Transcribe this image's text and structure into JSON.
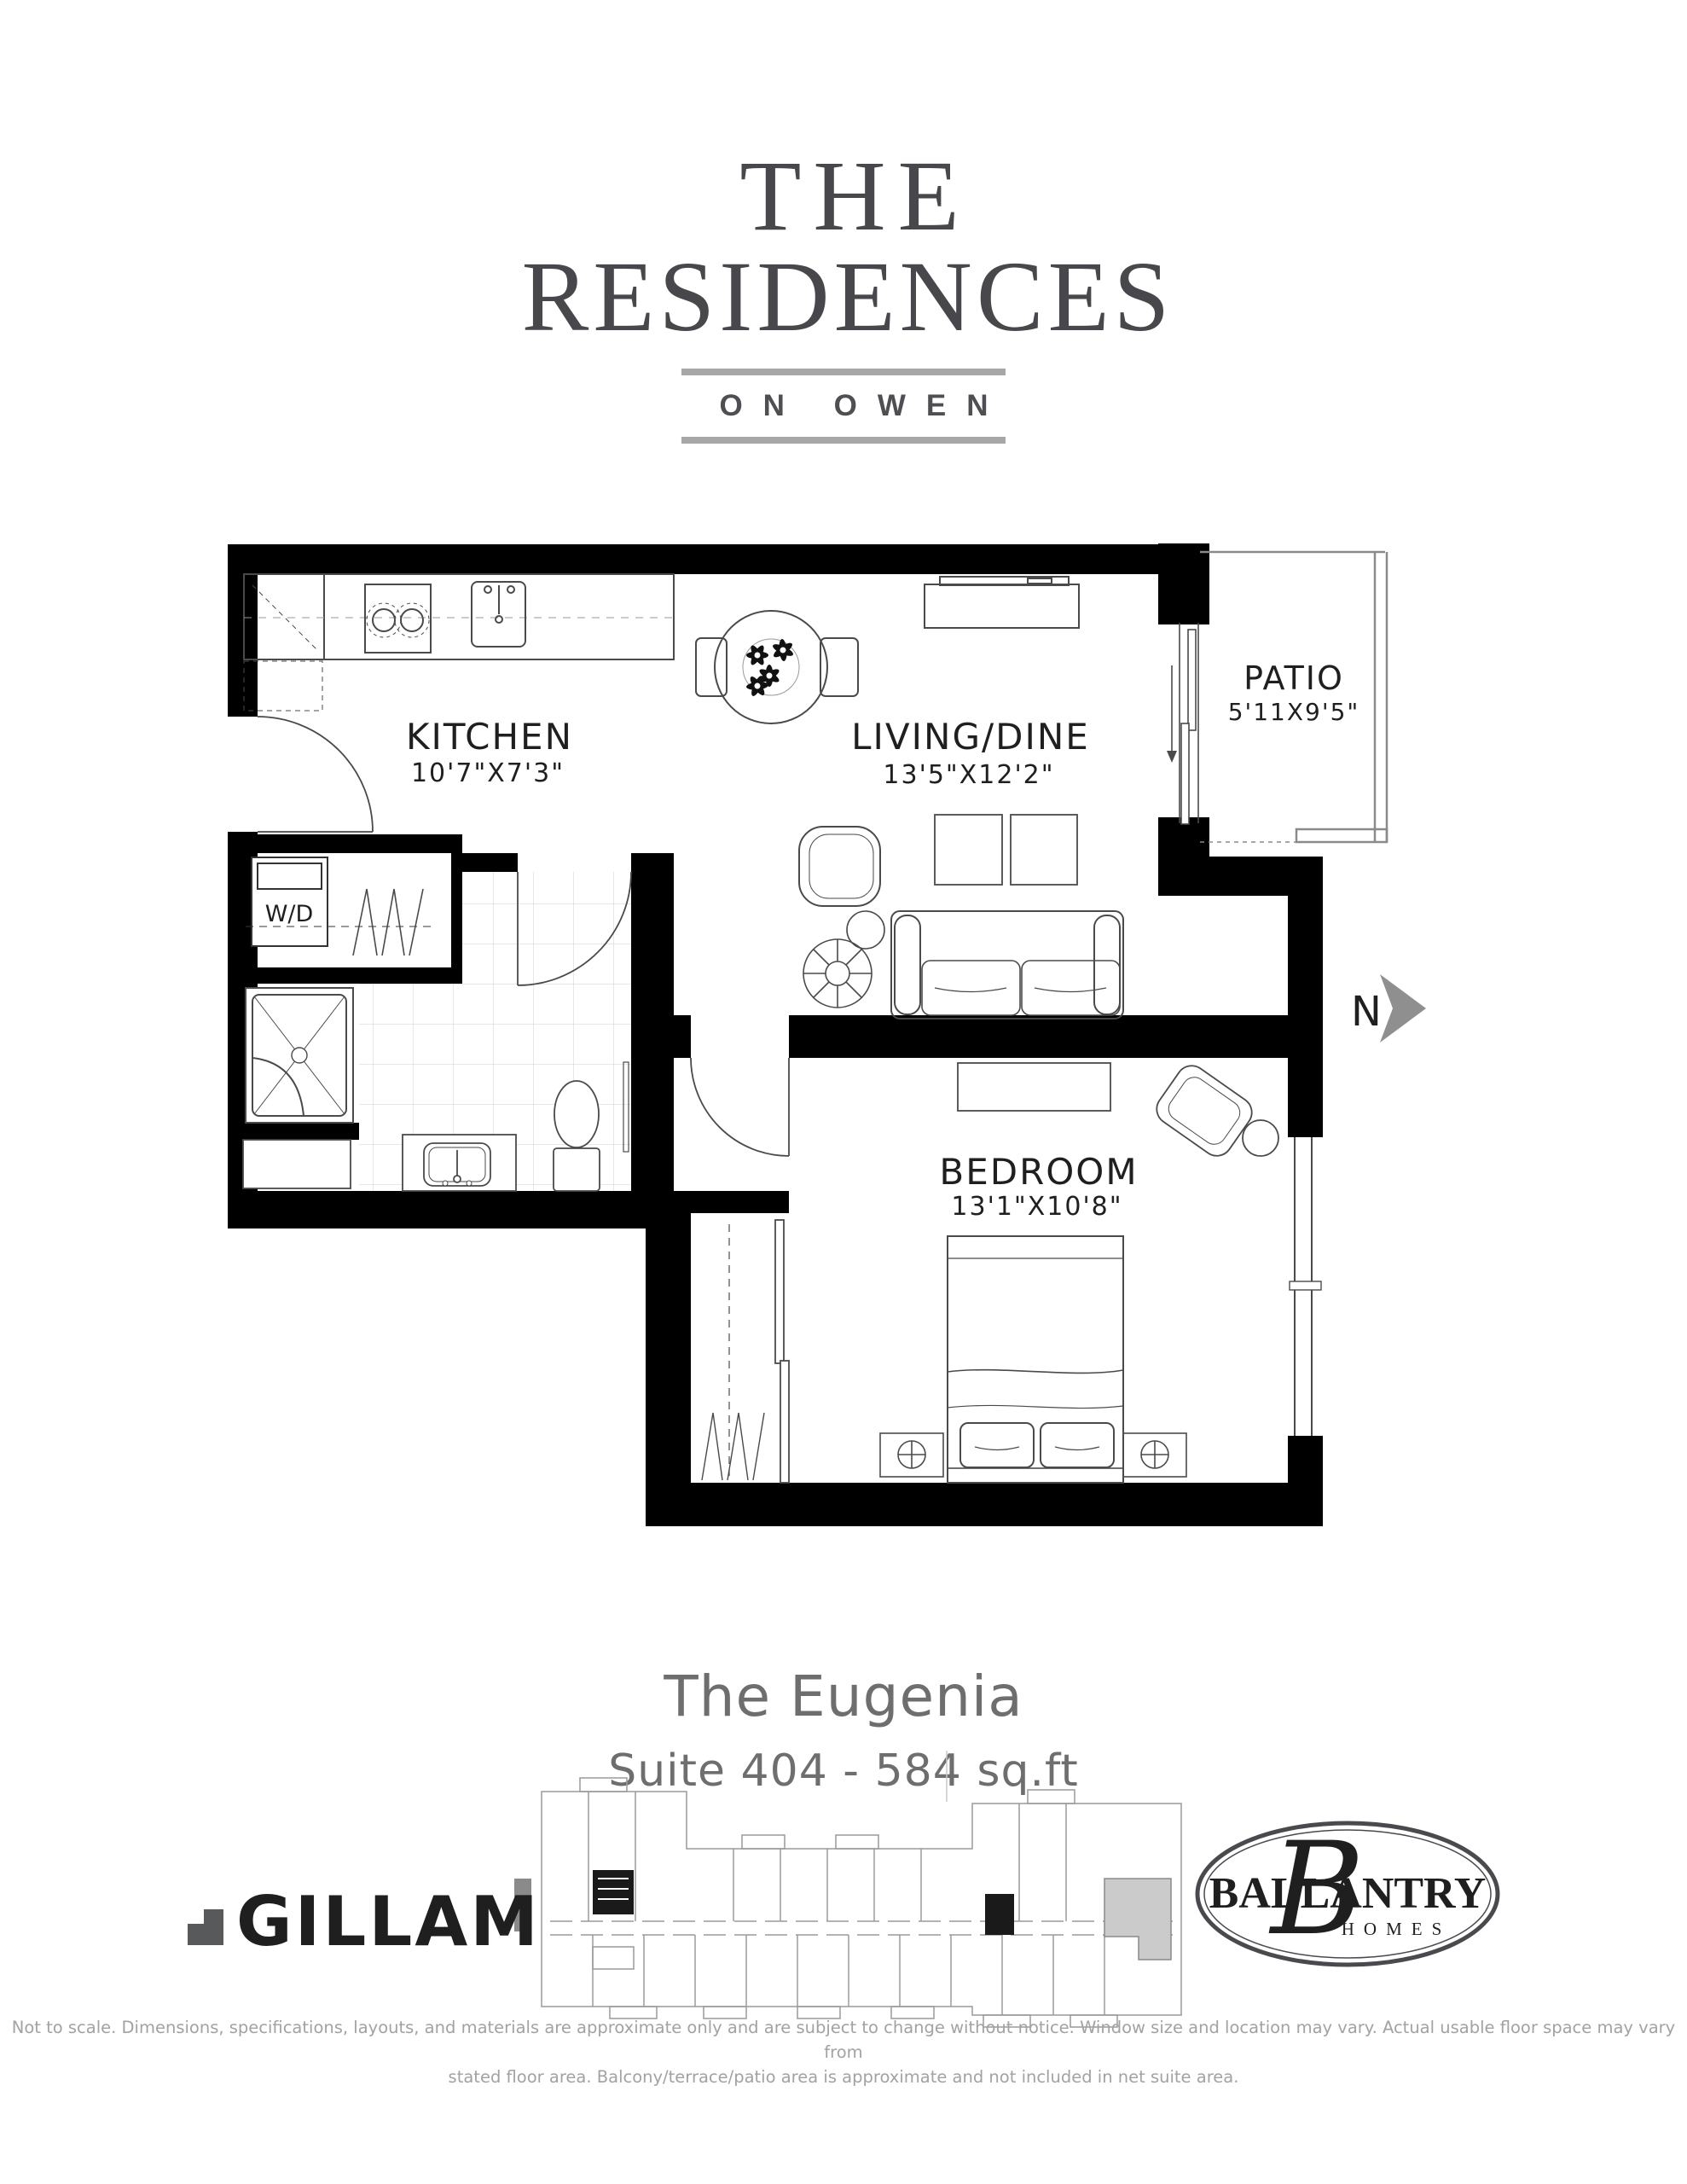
{
  "brand": {
    "the": "THE",
    "residences": "RESIDENCES",
    "tagline": "ON OWEN"
  },
  "plan": {
    "kitchen": {
      "name": "KITCHEN",
      "dims": "10'7\"X7'3\""
    },
    "living": {
      "name": "LIVING/DINE",
      "dims": "13'5\"X12'2\""
    },
    "patio": {
      "name": "PATIO",
      "dims": "5'11X9'5\""
    },
    "bedroom": {
      "name": "BEDROOM",
      "dims": "13'1\"X10'8\""
    },
    "washer_dryer": "W/D",
    "north": "N"
  },
  "suite": {
    "name": "The Eugenia",
    "info": "Suite 404 - 584 sq.ft"
  },
  "logos": {
    "gillam": "GILLAM",
    "ballantry": "BALLANTRY",
    "ballantry_sub": "HOMES",
    "ballantry_monogram": "B"
  },
  "disclaimer": {
    "line1": "Not to scale. Dimensions, specifications, layouts, and materials are approximate only and are subject to change without notice. Window size and location may vary. Actual usable floor space may vary from",
    "line2": "stated floor area. Balcony/terrace/patio area is approximate and not included in net suite area."
  }
}
